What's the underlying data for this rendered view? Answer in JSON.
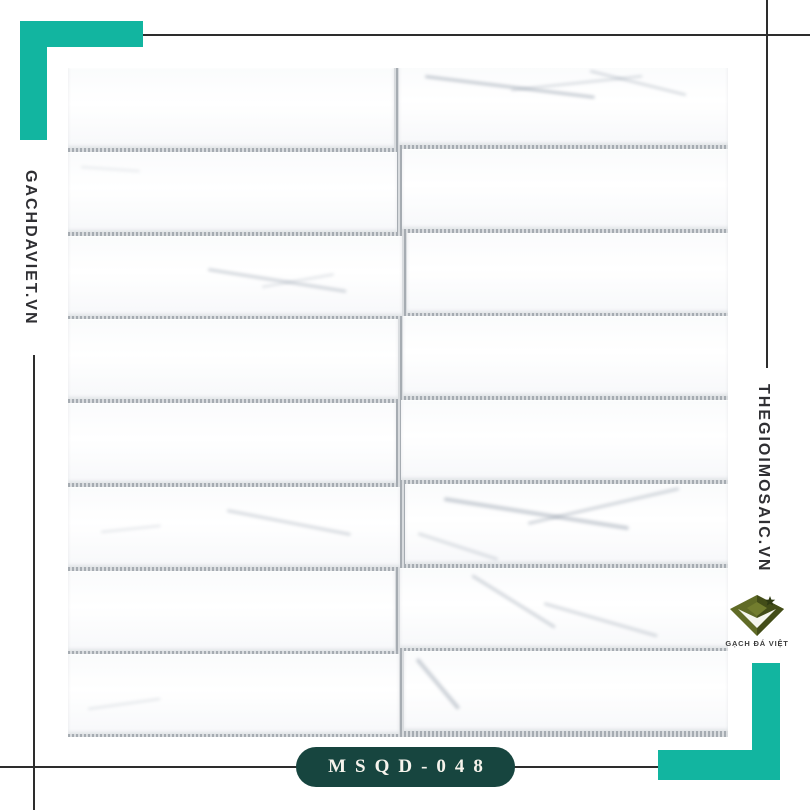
{
  "branding": {
    "left_watermark": "GACHDAVIET.VN",
    "right_watermark": "THEGIOIMOSAIC.VN",
    "product_code": "MSQD-048",
    "logo": {
      "caption": "GẠCH ĐÁ VIỆT",
      "icon": "gem-diamond-icon"
    }
  },
  "colors": {
    "accent_teal": "#12b5a0",
    "badge_green": "#17453f",
    "line_dark": "#2d2d2d",
    "watermark_ink": "#2f2f33",
    "grout_dark": "#a6acb2",
    "grout_light": "#d9dcdf",
    "tile_white": "#fdfdfe",
    "logo_olive": "#606b26",
    "logo_olive_dark": "#434d18"
  },
  "mosaic": {
    "description": "white marble stacked-strip mosaic, 8 rows x 2 columns",
    "rows": 8,
    "cols": 2,
    "width": 660,
    "height": 669,
    "row_pitch": 83.75,
    "grout_px": 4,
    "joint_px": 5,
    "left_tile_widths": [
      326,
      329,
      334,
      330,
      328,
      332,
      327,
      331
    ],
    "right_col_offset_y": -3,
    "veins": [
      {
        "row": 1,
        "col": 2,
        "x": "8%",
        "y": "12%",
        "w": "52%",
        "h": 3,
        "rot": 7,
        "opacity": 0.5
      },
      {
        "row": 1,
        "col": 2,
        "x": "34%",
        "y": "30%",
        "w": "40%",
        "h": 2,
        "rot": -6,
        "opacity": 0.4
      },
      {
        "row": 1,
        "col": 2,
        "x": "58%",
        "y": "6%",
        "w": "30%",
        "h": 2,
        "rot": 14,
        "opacity": 0.45
      },
      {
        "row": 2,
        "col": 1,
        "x": "4%",
        "y": "18%",
        "w": "18%",
        "h": 2,
        "rot": 4,
        "opacity": 0.2
      },
      {
        "row": 3,
        "col": 1,
        "x": "42%",
        "y": "40%",
        "w": "42%",
        "h": 3,
        "rot": 9,
        "opacity": 0.4
      },
      {
        "row": 3,
        "col": 1,
        "x": "58%",
        "y": "62%",
        "w": "22%",
        "h": 2,
        "rot": -10,
        "opacity": 0.3
      },
      {
        "row": 6,
        "col": 1,
        "x": "48%",
        "y": "28%",
        "w": "38%",
        "h": 3,
        "rot": 11,
        "opacity": 0.35
      },
      {
        "row": 6,
        "col": 1,
        "x": "10%",
        "y": "55%",
        "w": "18%",
        "h": 2,
        "rot": -6,
        "opacity": 0.25
      },
      {
        "row": 6,
        "col": 2,
        "x": "12%",
        "y": "16%",
        "w": "58%",
        "h": 4,
        "rot": 9,
        "opacity": 0.45
      },
      {
        "row": 6,
        "col": 2,
        "x": "38%",
        "y": "48%",
        "w": "48%",
        "h": 3,
        "rot": -13,
        "opacity": 0.4
      },
      {
        "row": 6,
        "col": 2,
        "x": "4%",
        "y": "60%",
        "w": "26%",
        "h": 3,
        "rot": 18,
        "opacity": 0.3
      },
      {
        "row": 7,
        "col": 2,
        "x": "22%",
        "y": "8%",
        "w": "30%",
        "h": 3,
        "rot": 32,
        "opacity": 0.4
      },
      {
        "row": 7,
        "col": 2,
        "x": "44%",
        "y": "42%",
        "w": "36%",
        "h": 3,
        "rot": 16,
        "opacity": 0.35
      },
      {
        "row": 8,
        "col": 2,
        "x": "4%",
        "y": "8%",
        "w": "20%",
        "h": 4,
        "rot": 50,
        "opacity": 0.45
      },
      {
        "row": 8,
        "col": 1,
        "x": "6%",
        "y": "68%",
        "w": "22%",
        "h": 2,
        "rot": -8,
        "opacity": 0.25
      }
    ]
  }
}
